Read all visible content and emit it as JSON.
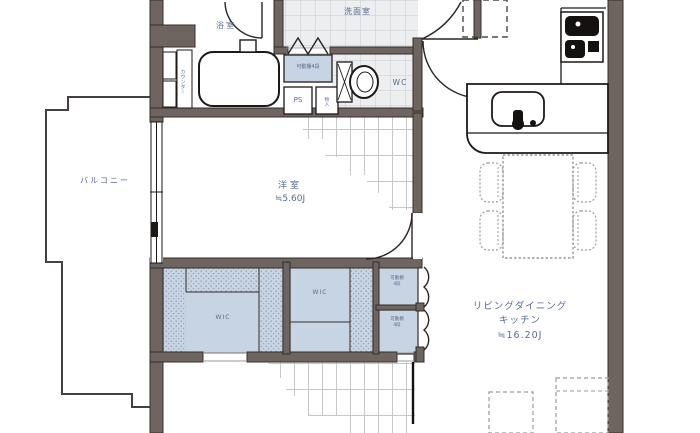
{
  "plan_title": "apartment-floor-plan",
  "colors": {
    "wall": "#6e6561",
    "line": "#2b2523",
    "label": "#5a6a8d",
    "closet": "#c7d4e3",
    "tile_bg": "#eceef0",
    "tile_line": "#c7cbd0",
    "plank_line": "#c6c6c6",
    "furniture_line": "#9a9a9a"
  },
  "rooms": {
    "balcony": {
      "label": "バルコニー"
    },
    "bathroom": {
      "label": "浴室"
    },
    "washroom": {
      "label": "洗面室"
    },
    "wc": {
      "label": "WC"
    },
    "western_room": {
      "label": "洋室",
      "area": "≒5.60J"
    },
    "ldk": {
      "label_line1": "リビングダイニング",
      "label_line2": "キッチン",
      "area": "≒16.20J"
    },
    "wic_left": {
      "label": "WIC"
    },
    "wic_right": {
      "label": "WIC"
    }
  },
  "fixtures": {
    "counter": {
      "label": "カウンター"
    },
    "shelf_top": {
      "label": "可動棚4段"
    },
    "pipe_space": {
      "label": "PS"
    },
    "storage": {
      "label": "物入"
    },
    "shelf_upper": {
      "label_line1": "可動棚",
      "label_line2": "4段"
    },
    "shelf_lower": {
      "label_line1": "可動棚",
      "label_line2": "4段"
    }
  }
}
